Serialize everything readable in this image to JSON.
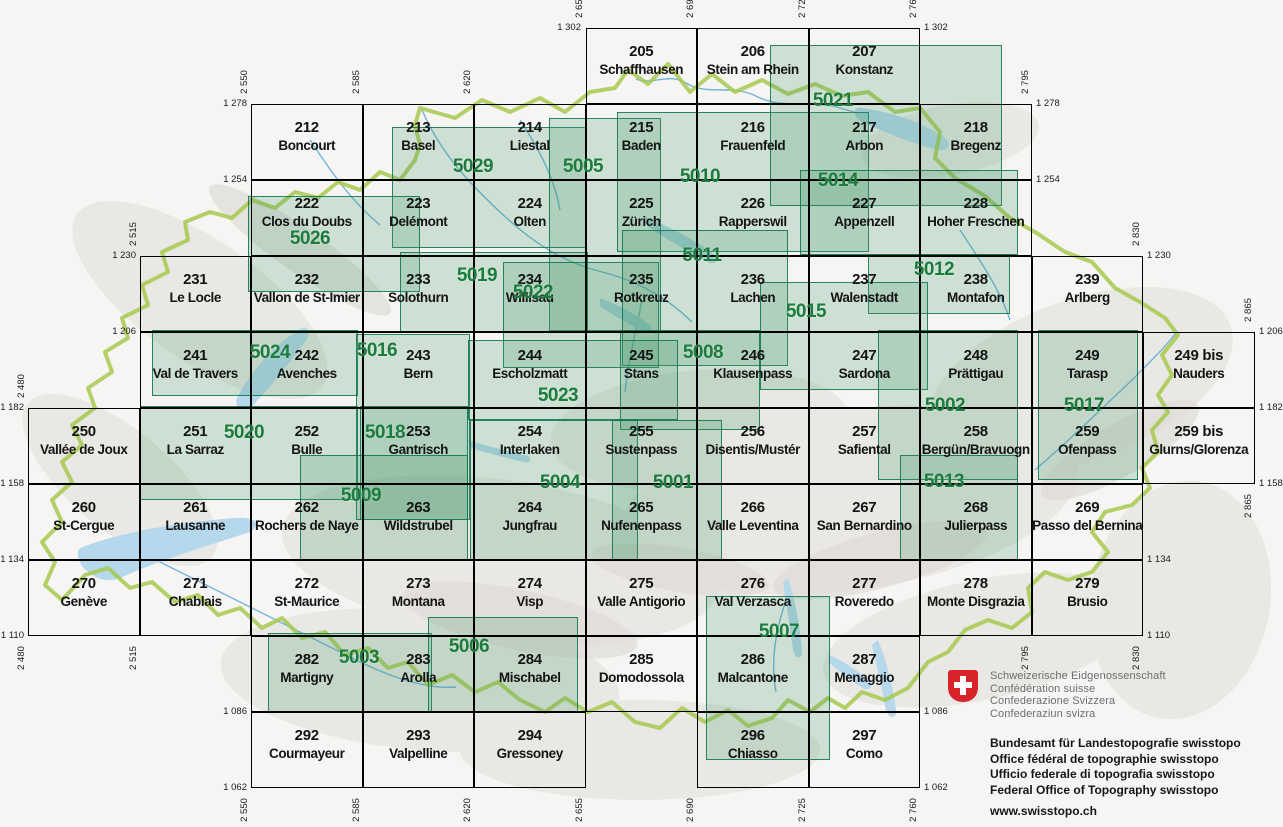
{
  "map_title": "Swiss national map 1:50000 sheet index",
  "sheets": [
    {
      "num": "205",
      "name": "Schaffhausen",
      "e": 2655,
      "n": 1302
    },
    {
      "num": "206",
      "name": "Stein am Rhein",
      "e": 2690,
      "n": 1302
    },
    {
      "num": "207",
      "name": "Konstanz",
      "e": 2725,
      "n": 1302
    },
    {
      "num": "212",
      "name": "Boncourt",
      "e": 2550,
      "n": 1278
    },
    {
      "num": "213",
      "name": "Basel",
      "e": 2585,
      "n": 1278
    },
    {
      "num": "214",
      "name": "Liestal",
      "e": 2620,
      "n": 1278
    },
    {
      "num": "215",
      "name": "Baden",
      "e": 2655,
      "n": 1278
    },
    {
      "num": "216",
      "name": "Frauenfeld",
      "e": 2690,
      "n": 1278
    },
    {
      "num": "217",
      "name": "Arbon",
      "e": 2725,
      "n": 1278
    },
    {
      "num": "218",
      "name": "Bregenz",
      "e": 2760,
      "n": 1278
    },
    {
      "num": "222",
      "name": "Clos du Doubs",
      "e": 2550,
      "n": 1254
    },
    {
      "num": "223",
      "name": "Delémont",
      "e": 2585,
      "n": 1254
    },
    {
      "num": "224",
      "name": "Olten",
      "e": 2620,
      "n": 1254
    },
    {
      "num": "225",
      "name": "Zürich",
      "e": 2655,
      "n": 1254
    },
    {
      "num": "226",
      "name": "Rapperswil",
      "e": 2690,
      "n": 1254
    },
    {
      "num": "227",
      "name": "Appenzell",
      "e": 2725,
      "n": 1254
    },
    {
      "num": "228",
      "name": "Hoher Freschen",
      "e": 2760,
      "n": 1254
    },
    {
      "num": "231",
      "name": "Le Locle",
      "e": 2515,
      "n": 1230
    },
    {
      "num": "232",
      "name": "Vallon de St-Imier",
      "e": 2550,
      "n": 1230
    },
    {
      "num": "233",
      "name": "Solothurn",
      "e": 2585,
      "n": 1230
    },
    {
      "num": "234",
      "name": "Willisau",
      "e": 2620,
      "n": 1230
    },
    {
      "num": "235",
      "name": "Rotkreuz",
      "e": 2655,
      "n": 1230
    },
    {
      "num": "236",
      "name": "Lachen",
      "e": 2690,
      "n": 1230
    },
    {
      "num": "237",
      "name": "Walenstadt",
      "e": 2725,
      "n": 1230
    },
    {
      "num": "238",
      "name": "Montafon",
      "e": 2760,
      "n": 1230
    },
    {
      "num": "239",
      "name": "Arlberg",
      "e": 2795,
      "n": 1230
    },
    {
      "num": "241",
      "name": "Val de Travers",
      "e": 2515,
      "n": 1206
    },
    {
      "num": "242",
      "name": "Avenches",
      "e": 2550,
      "n": 1206
    },
    {
      "num": "243",
      "name": "Bern",
      "e": 2585,
      "n": 1206
    },
    {
      "num": "244",
      "name": "Escholzmatt",
      "e": 2620,
      "n": 1206
    },
    {
      "num": "245",
      "name": "Stans",
      "e": 2655,
      "n": 1206
    },
    {
      "num": "246",
      "name": "Klausenpass",
      "e": 2690,
      "n": 1206
    },
    {
      "num": "247",
      "name": "Sardona",
      "e": 2725,
      "n": 1206
    },
    {
      "num": "248",
      "name": "Prättigau",
      "e": 2760,
      "n": 1206
    },
    {
      "num": "249",
      "name": "Tarasp",
      "e": 2795,
      "n": 1206
    },
    {
      "num": "249 bis",
      "name": "Nauders",
      "e": 2830,
      "n": 1206
    },
    {
      "num": "250",
      "name": "Vallée de Joux",
      "e": 2480,
      "n": 1182
    },
    {
      "num": "251",
      "name": "La Sarraz",
      "e": 2515,
      "n": 1182
    },
    {
      "num": "252",
      "name": "Bulle",
      "e": 2550,
      "n": 1182
    },
    {
      "num": "253",
      "name": "Gantrisch",
      "e": 2585,
      "n": 1182
    },
    {
      "num": "254",
      "name": "Interlaken",
      "e": 2620,
      "n": 1182
    },
    {
      "num": "255",
      "name": "Sustenpass",
      "e": 2655,
      "n": 1182
    },
    {
      "num": "256",
      "name": "Disentis/Mustér",
      "e": 2690,
      "n": 1182
    },
    {
      "num": "257",
      "name": "Safiental",
      "e": 2725,
      "n": 1182
    },
    {
      "num": "258",
      "name": "Bergün/Bravuogn",
      "e": 2760,
      "n": 1182
    },
    {
      "num": "259",
      "name": "Ofenpass",
      "e": 2795,
      "n": 1182
    },
    {
      "num": "259 bis",
      "name": "Glurns/Glorenza",
      "e": 2830,
      "n": 1182
    },
    {
      "num": "260",
      "name": "St-Cergue",
      "e": 2480,
      "n": 1158
    },
    {
      "num": "261",
      "name": "Lausanne",
      "e": 2515,
      "n": 1158
    },
    {
      "num": "262",
      "name": "Rochers de Naye",
      "e": 2550,
      "n": 1158
    },
    {
      "num": "263",
      "name": "Wildstrubel",
      "e": 2585,
      "n": 1158
    },
    {
      "num": "264",
      "name": "Jungfrau",
      "e": 2620,
      "n": 1158
    },
    {
      "num": "265",
      "name": "Nufenenpass",
      "e": 2655,
      "n": 1158
    },
    {
      "num": "266",
      "name": "Valle Leventina",
      "e": 2690,
      "n": 1158
    },
    {
      "num": "267",
      "name": "San Bernardino",
      "e": 2725,
      "n": 1158
    },
    {
      "num": "268",
      "name": "Julierpass",
      "e": 2760,
      "n": 1158
    },
    {
      "num": "269",
      "name": "Passo del Bernina",
      "e": 2795,
      "n": 1158
    },
    {
      "num": "270",
      "name": "Genève",
      "e": 2480,
      "n": 1134
    },
    {
      "num": "271",
      "name": "Chablais",
      "e": 2515,
      "n": 1134
    },
    {
      "num": "272",
      "name": "St-Maurice",
      "e": 2550,
      "n": 1134
    },
    {
      "num": "273",
      "name": "Montana",
      "e": 2585,
      "n": 1134
    },
    {
      "num": "274",
      "name": "Visp",
      "e": 2620,
      "n": 1134
    },
    {
      "num": "275",
      "name": "Valle Antigorio",
      "e": 2655,
      "n": 1134
    },
    {
      "num": "276",
      "name": "Val Verzasca",
      "e": 2690,
      "n": 1134
    },
    {
      "num": "277",
      "name": "Roveredo",
      "e": 2725,
      "n": 1134
    },
    {
      "num": "278",
      "name": "Monte Disgrazia",
      "e": 2760,
      "n": 1134
    },
    {
      "num": "279",
      "name": "Brusio",
      "e": 2795,
      "n": 1134
    },
    {
      "num": "282",
      "name": "Martigny",
      "e": 2550,
      "n": 1110
    },
    {
      "num": "283",
      "name": "Arolla",
      "e": 2585,
      "n": 1110
    },
    {
      "num": "284",
      "name": "Mischabel",
      "e": 2620,
      "n": 1110
    },
    {
      "num": "285",
      "name": "Domodossola",
      "e": 2655,
      "n": 1110
    },
    {
      "num": "286",
      "name": "Malcantone",
      "e": 2690,
      "n": 1110
    },
    {
      "num": "287",
      "name": "Menaggio",
      "e": 2725,
      "n": 1110
    },
    {
      "num": "292",
      "name": "Courmayeur",
      "e": 2550,
      "n": 1086
    },
    {
      "num": "293",
      "name": "Valpelline",
      "e": 2585,
      "n": 1086
    },
    {
      "num": "294",
      "name": "Gressoney",
      "e": 2620,
      "n": 1086
    },
    {
      "num": "296",
      "name": "Chiasso",
      "e": 2690,
      "n": 1086
    },
    {
      "num": "297",
      "name": "Como",
      "e": 2725,
      "n": 1086
    }
  ],
  "composites": [
    {
      "num": "5029",
      "rect": [
        392,
        127,
        194,
        121
      ],
      "label": [
        473,
        168
      ]
    },
    {
      "num": "5005",
      "rect": [
        549,
        118,
        112,
        213
      ],
      "label": [
        583,
        168
      ]
    },
    {
      "num": "5010",
      "rect": [
        617,
        112,
        252,
        140
      ],
      "label": [
        700,
        178
      ]
    },
    {
      "num": "5021",
      "rect": [
        770,
        45,
        232,
        161
      ],
      "label": [
        833,
        102
      ]
    },
    {
      "num": "5014",
      "rect": [
        800,
        170,
        218,
        85
      ],
      "label": [
        838,
        182
      ]
    },
    {
      "num": "5026",
      "rect": [
        248,
        196,
        172,
        96
      ],
      "label": [
        310,
        240
      ]
    },
    {
      "num": "5019",
      "rect": [
        400,
        252,
        188,
        80
      ],
      "label": [
        477,
        277
      ]
    },
    {
      "num": "5022",
      "rect": [
        503,
        262,
        156,
        106
      ],
      "label": [
        533,
        294
      ]
    },
    {
      "num": "5011",
      "rect": [
        622,
        230,
        166,
        136
      ],
      "label": [
        702,
        257
      ]
    },
    {
      "num": "5012",
      "rect": [
        868,
        254,
        142,
        60
      ],
      "label": [
        934,
        271
      ]
    },
    {
      "num": "5015",
      "rect": [
        760,
        282,
        168,
        108
      ],
      "label": [
        806,
        313
      ]
    },
    {
      "num": "5024",
      "rect": [
        152,
        330,
        206,
        66
      ],
      "label": [
        270,
        354
      ]
    },
    {
      "num": "5016",
      "rect": [
        356,
        334,
        114,
        186
      ],
      "label": [
        377,
        352
      ]
    },
    {
      "num": "5008",
      "rect": [
        620,
        330,
        140,
        100
      ],
      "label": [
        703,
        354
      ]
    },
    {
      "num": "5023",
      "rect": [
        468,
        340,
        210,
        80
      ],
      "label": [
        558,
        397
      ]
    },
    {
      "num": "5002",
      "rect": [
        878,
        330,
        140,
        150
      ],
      "label": [
        945,
        407
      ]
    },
    {
      "num": "5017",
      "rect": [
        1038,
        330,
        100,
        150
      ],
      "label": [
        1084,
        407
      ]
    },
    {
      "num": "5020",
      "rect": [
        140,
        406,
        218,
        94
      ],
      "label": [
        244,
        434
      ]
    },
    {
      "num": "5018",
      "rect": [
        360,
        406,
        108,
        114
      ],
      "label": [
        385,
        434
      ]
    },
    {
      "num": "5009",
      "rect": [
        300,
        455,
        168,
        105
      ],
      "label": [
        361,
        497
      ]
    },
    {
      "num": "5004",
      "rect": [
        470,
        420,
        168,
        140
      ],
      "label": [
        560,
        484
      ]
    },
    {
      "num": "5001",
      "rect": [
        612,
        420,
        110,
        140
      ],
      "label": [
        673,
        484
      ]
    },
    {
      "num": "5013",
      "rect": [
        900,
        455,
        118,
        105
      ],
      "label": [
        944,
        483
      ]
    },
    {
      "num": "5003",
      "rect": [
        268,
        633,
        164,
        80
      ],
      "label": [
        359,
        659
      ]
    },
    {
      "num": "5006",
      "rect": [
        428,
        617,
        150,
        96
      ],
      "label": [
        469,
        648
      ]
    },
    {
      "num": "5007",
      "rect": [
        706,
        596,
        124,
        164
      ],
      "label": [
        779,
        633
      ]
    }
  ],
  "coord_labels_h": [
    {
      "t": "1 302",
      "x": 585,
      "y": 28,
      "side": "L"
    },
    {
      "t": "1 302",
      "x": 920,
      "y": 28,
      "side": "R"
    },
    {
      "t": "1 278",
      "x": 251,
      "y": 104,
      "side": "L"
    },
    {
      "t": "1 278",
      "x": 1032,
      "y": 104,
      "side": "R"
    },
    {
      "t": "1 254",
      "x": 251,
      "y": 180,
      "side": "L"
    },
    {
      "t": "1 254",
      "x": 1032,
      "y": 180,
      "side": "R"
    },
    {
      "t": "1 230",
      "x": 140,
      "y": 256,
      "side": "L"
    },
    {
      "t": "1 230",
      "x": 1143,
      "y": 256,
      "side": "R"
    },
    {
      "t": "1 206",
      "x": 140,
      "y": 332,
      "side": "L"
    },
    {
      "t": "1 206",
      "x": 1255,
      "y": 332,
      "side": "R"
    },
    {
      "t": "1 182",
      "x": 28,
      "y": 408,
      "side": "L"
    },
    {
      "t": "1 182",
      "x": 1255,
      "y": 408,
      "side": "R"
    },
    {
      "t": "1 158",
      "x": 28,
      "y": 484,
      "side": "L"
    },
    {
      "t": "1 158",
      "x": 1255,
      "y": 484,
      "side": "R"
    },
    {
      "t": "1 134",
      "x": 28,
      "y": 560,
      "side": "L"
    },
    {
      "t": "1 134",
      "x": 1143,
      "y": 560,
      "side": "R"
    },
    {
      "t": "1 110",
      "x": 28,
      "y": 636,
      "side": "L"
    },
    {
      "t": "1 110",
      "x": 1143,
      "y": 636,
      "side": "R"
    },
    {
      "t": "1 086",
      "x": 251,
      "y": 712,
      "side": "L"
    },
    {
      "t": "1 086",
      "x": 920,
      "y": 712,
      "side": "R"
    },
    {
      "t": "1 062",
      "x": 251,
      "y": 788,
      "side": "L"
    },
    {
      "t": "1 062",
      "x": 920,
      "y": 788,
      "side": "R"
    }
  ],
  "coord_labels_v": [
    {
      "t": "2 655",
      "e": 2655,
      "y": 28,
      "pos": "above"
    },
    {
      "t": "2 690",
      "e": 2690,
      "y": 28,
      "pos": "above"
    },
    {
      "t": "2 725",
      "e": 2725,
      "y": 28,
      "pos": "above"
    },
    {
      "t": "2 760",
      "e": 2760,
      "y": 28,
      "pos": "above"
    },
    {
      "t": "2 550",
      "e": 2550,
      "y": 104,
      "pos": "above"
    },
    {
      "t": "2 585",
      "e": 2585,
      "y": 104,
      "pos": "above"
    },
    {
      "t": "2 620",
      "e": 2620,
      "y": 104,
      "pos": "above"
    },
    {
      "t": "2 795",
      "e": 2795,
      "y": 104,
      "pos": "above"
    },
    {
      "t": "2 515",
      "e": 2515,
      "y": 256,
      "pos": "above"
    },
    {
      "t": "2 830",
      "e": 2830,
      "y": 256,
      "pos": "above"
    },
    {
      "t": "2 865",
      "e": 2865,
      "y": 332,
      "pos": "above"
    },
    {
      "t": "2 480",
      "e": 2480,
      "y": 408,
      "pos": "above"
    },
    {
      "t": "2 865",
      "e": 2865,
      "y": 484,
      "pos": "below"
    },
    {
      "t": "2 480",
      "e": 2480,
      "y": 636,
      "pos": "below"
    },
    {
      "t": "2 515",
      "e": 2515,
      "y": 636,
      "pos": "below"
    },
    {
      "t": "2 795",
      "e": 2795,
      "y": 636,
      "pos": "below"
    },
    {
      "t": "2 830",
      "e": 2830,
      "y": 636,
      "pos": "below"
    },
    {
      "t": "2 550",
      "e": 2550,
      "y": 788,
      "pos": "below"
    },
    {
      "t": "2 585",
      "e": 2585,
      "y": 788,
      "pos": "below"
    },
    {
      "t": "2 620",
      "e": 2620,
      "y": 788,
      "pos": "below"
    },
    {
      "t": "2 655",
      "e": 2655,
      "y": 788,
      "pos": "below"
    },
    {
      "t": "2 690",
      "e": 2690,
      "y": 788,
      "pos": "below"
    },
    {
      "t": "2 725",
      "e": 2725,
      "y": 788,
      "pos": "below"
    },
    {
      "t": "2 760",
      "e": 2760,
      "y": 788,
      "pos": "below"
    }
  ],
  "footer": {
    "confederation": [
      "Schweizerische Eidgenossenschaft",
      "Confédération suisse",
      "Confederazione Svizzera",
      "Confederaziun svizra"
    ],
    "office": [
      "Bundesamt für Landestopografie swisstopo",
      "Office fédéral de topographie swisstopo",
      "Ufficio federale di topografia swisstopo",
      "Federal Office of Topography swisstopo"
    ],
    "url": "www.swisstopo.ch"
  },
  "colors": {
    "composite_fill": "#3e9862",
    "composite_border": "#0a734b",
    "composite_label": "#1b7c3e",
    "grid_line": "#000000",
    "country_border": "#a6c94e",
    "lake": "#b5d8ec",
    "river": "#58a8d8",
    "shield_red": "#d8232a"
  }
}
